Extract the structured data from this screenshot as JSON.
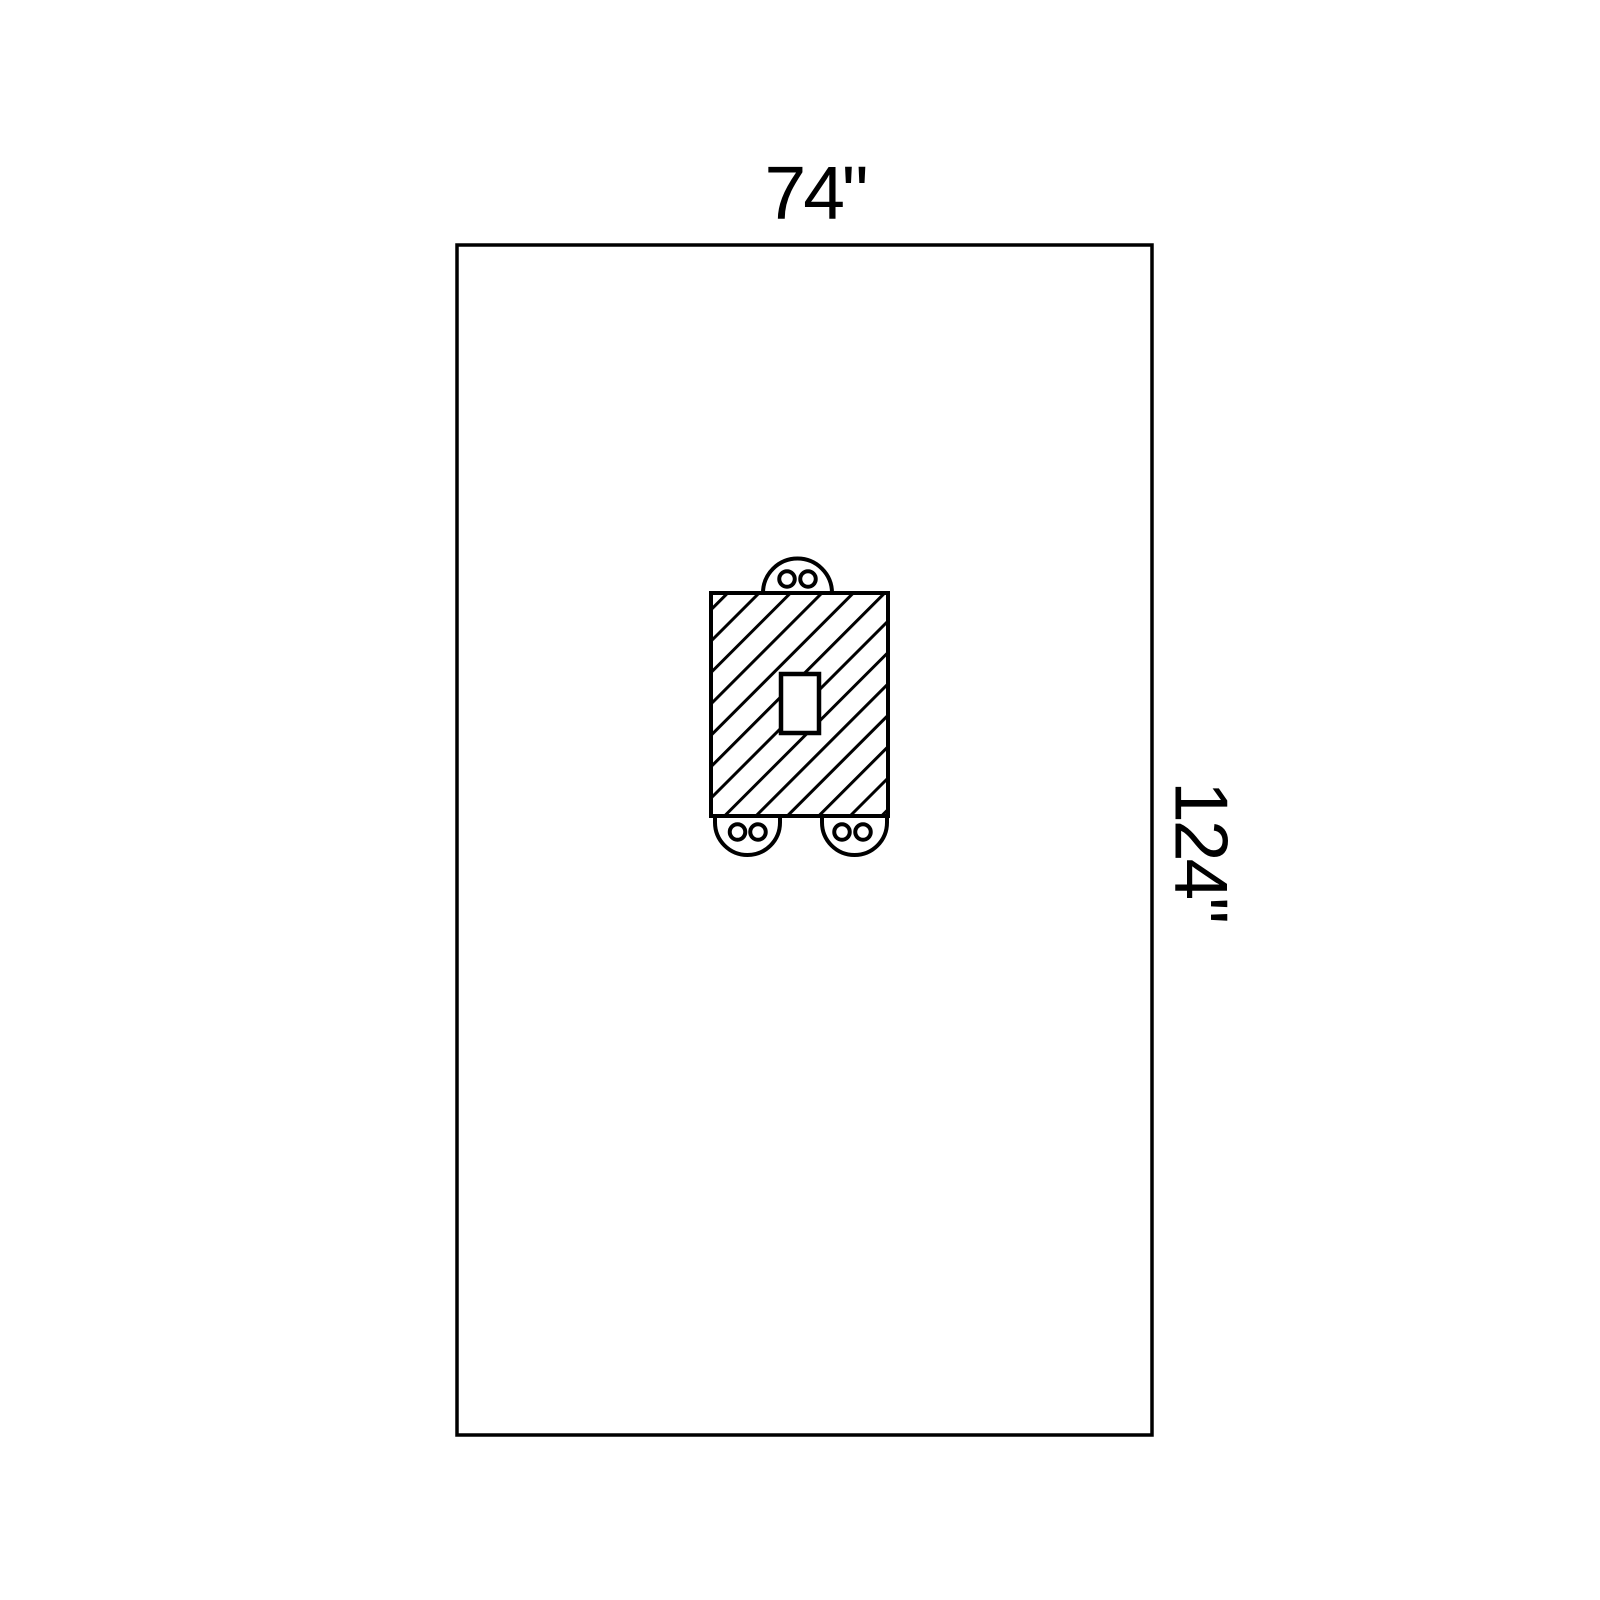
{
  "diagram": {
    "width_label": "74\"",
    "height_label": "124\"",
    "colors": {
      "line": "#000000",
      "background": "#ffffff"
    }
  }
}
